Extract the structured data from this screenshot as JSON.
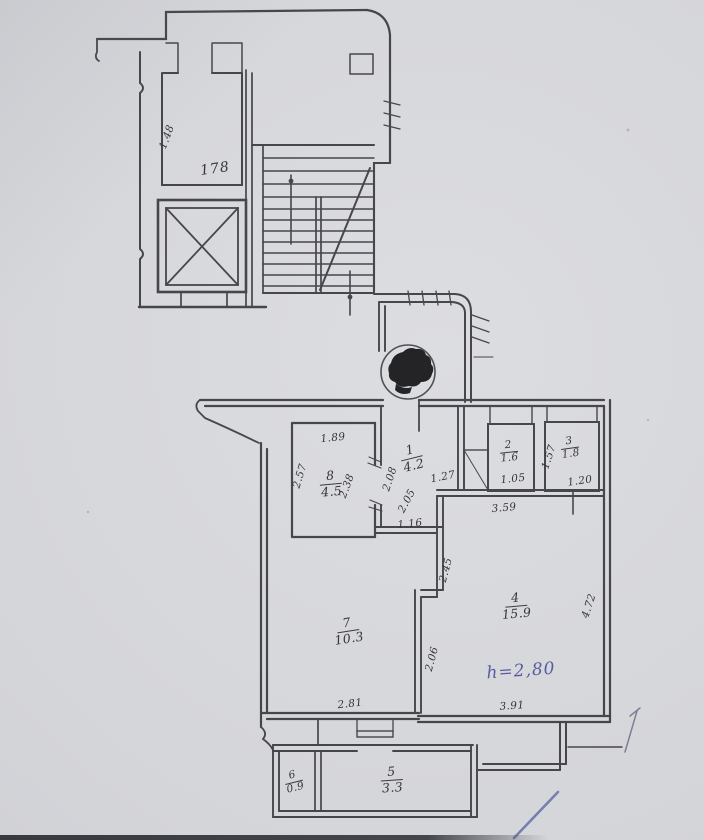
{
  "meta": {
    "title": "Scanned apartment floor plan with stairwell"
  },
  "colors": {
    "paper": "#d5d6da",
    "ink": "#3b3b42",
    "pen_blue": "#575c9e",
    "stamp": "#17171a"
  },
  "rooms": [
    {
      "num": "1",
      "area": "4.2"
    },
    {
      "num": "2",
      "area": "1.6"
    },
    {
      "num": "3",
      "area": "1.8"
    },
    {
      "num": "4",
      "area": "15.9"
    },
    {
      "num": "5",
      "area": "3.3"
    },
    {
      "num": "6",
      "area": "0.9"
    },
    {
      "num": "7",
      "area": "10.3"
    },
    {
      "num": "8",
      "area": "4.5"
    }
  ],
  "dims": [
    {
      "text": "1.89"
    },
    {
      "text": "2.57"
    },
    {
      "text": "2.38"
    },
    {
      "text": "2.08"
    },
    {
      "text": "2.05"
    },
    {
      "text": "1.16"
    },
    {
      "text": "1.27"
    },
    {
      "text": "1.05"
    },
    {
      "text": "1.57"
    },
    {
      "text": "1.20"
    },
    {
      "text": "3.59"
    },
    {
      "text": "4.72"
    },
    {
      "text": "3.91"
    },
    {
      "text": "2.45"
    },
    {
      "text": "2.06"
    },
    {
      "text": "2.81"
    },
    {
      "text": "1.48"
    },
    {
      "text": "178"
    }
  ],
  "annotations": {
    "height_note": "h=2,80"
  }
}
